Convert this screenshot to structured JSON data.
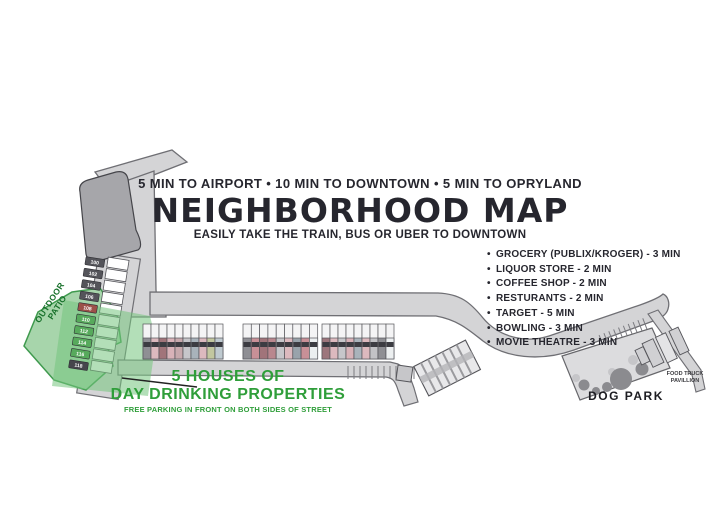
{
  "header": {
    "distances": "5 MIN TO AIRPORT • 10 MIN TO DOWNTOWN • 5 MIN TO OPRYLAND",
    "title": "NEIGHBORHOOD MAP",
    "subtitle": "EASILY TAKE THE TRAIN, BUS OR UBER TO DOWNTOWN"
  },
  "amenities": {
    "bullet_char": "•",
    "items": [
      "GROCERY (PUBLIX/KROGER) - 3 MIN",
      "LIQUOR STORE - 2 MIN",
      "COFFEE SHOP - 2 MIN",
      "RESTURANTS - 2 MIN",
      "TARGET - 5 MIN",
      "BOWLING - 3 MIN",
      "MOVIE THEATRE - 3 MIN"
    ]
  },
  "callout": {
    "line1": "5 HOUSES OF",
    "line2": "DAY DRINKING PROPERTIES",
    "line3": "FREE PARKING IN FRONT ON BOTH SIDES OF STREET"
  },
  "labels": {
    "dog_park": "DOG PARK",
    "food_truck_line1": "FOOD TRUCK",
    "food_truck_line2": "PAVILLION",
    "outdoor_patio_line1": "OUTDOOR",
    "outdoor_patio_line2": "PATIO"
  },
  "map": {
    "colors": {
      "road_fill": "#d4d4d6",
      "road_edge": "#6f6f74",
      "building_fill": "#a6a6aa",
      "green_zone_fill": "#a7d5ab",
      "green_zone_edge": "#3f9a4e",
      "green_overlay": "rgba(116,197,126,0.55)",
      "dogpark_fill": "#dcdcde",
      "tree_dark": "#8b8b8f",
      "tree_light": "#c6c6c9",
      "accent_green_text": "#2f9e3a",
      "house_roof": "#f4f4f5",
      "house_outline": "#55555a"
    },
    "lane_badges": [
      {
        "label": "100",
        "color": "#54545a"
      },
      {
        "label": "102",
        "color": "#54545a"
      },
      {
        "label": "104",
        "color": "#54545a"
      },
      {
        "label": "106",
        "color": "#54545a"
      },
      {
        "label": "108",
        "color": "#9c5149"
      },
      {
        "label": "110",
        "color": "#57aa5c"
      },
      {
        "label": "112",
        "color": "#57aa5c"
      },
      {
        "label": "114",
        "color": "#57aa5c"
      },
      {
        "label": "116",
        "color": "#57aa5c"
      },
      {
        "label": "118",
        "color": "#46464c"
      }
    ],
    "street_house_groups": [
      {
        "x": 143,
        "unit_width": 8.0,
        "colors": [
          "#8f8f94",
          "#dcb9be",
          "#a1747a",
          "#d8b2b8",
          "#c7a9ad",
          "#c6c6ca",
          "#a9b3bb",
          "#dcb9be",
          "#c2c79f",
          "#bfcad0"
        ]
      },
      {
        "x": 243,
        "unit_width": 8.3,
        "colors": [
          "#8f8f94",
          "#c89097",
          "#a1747a",
          "#b9878e",
          "#c6c6ca",
          "#dcb9be",
          "#99a3ab",
          "#c89097",
          "#eceff0"
        ]
      },
      {
        "x": 322,
        "unit_width": 8.0,
        "colors": [
          "#9d767c",
          "#dcb9be",
          "#c6c6ca",
          "#d8b2b8",
          "#a9b3bb",
          "#dcb9be",
          "#c2c2c6",
          "#8f8f94",
          "#eceff0"
        ]
      }
    ]
  }
}
